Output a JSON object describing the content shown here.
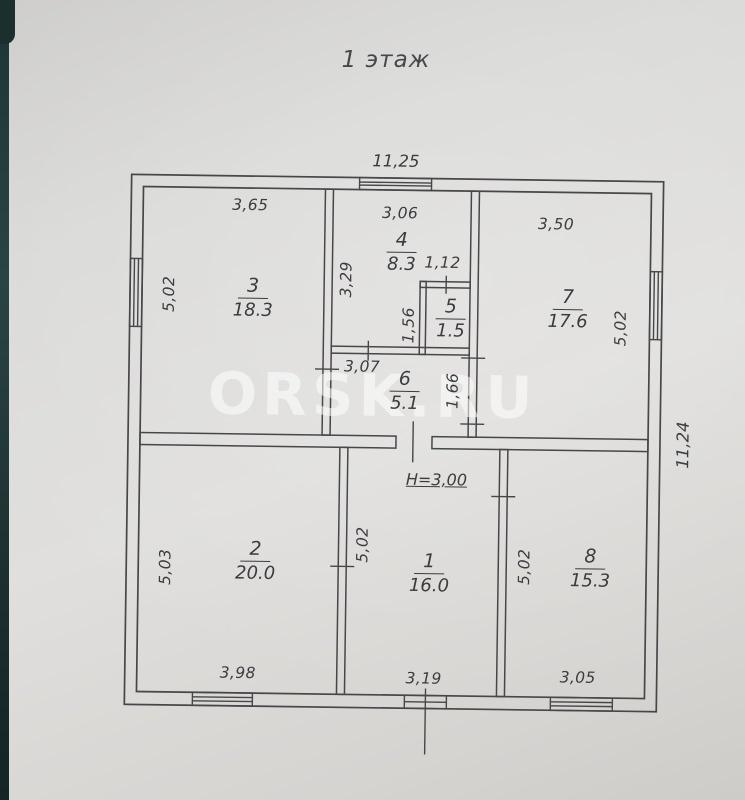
{
  "title": "1 этаж",
  "watermark": "ORSK.RU",
  "overall": {
    "width_top": "11,25",
    "depth_right": "11,24",
    "ceiling_height_note": "H=3,00"
  },
  "rooms": {
    "r1": {
      "number": "1",
      "area": "16.0",
      "left": "5,02",
      "bottom": "3,19"
    },
    "r2": {
      "number": "2",
      "area": "20.0",
      "left": "5,03",
      "bottom": "3,98"
    },
    "r3": {
      "number": "3",
      "area": "18.3",
      "top": "3,65",
      "left": "5,02"
    },
    "r4": {
      "number": "4",
      "area": "8.3",
      "top": "3,06",
      "left": "3,29"
    },
    "r5": {
      "number": "5",
      "area": "1.5",
      "top": "1,12",
      "left": "1,56"
    },
    "r6": {
      "number": "6",
      "area": "5.1",
      "top": "3,07",
      "right": "1,66"
    },
    "r7": {
      "number": "7",
      "area": "17.6",
      "top": "3,50",
      "right": "5,02"
    },
    "r8": {
      "number": "8",
      "area": "15.3",
      "left": "5,02",
      "bottom": "3,05"
    }
  }
}
